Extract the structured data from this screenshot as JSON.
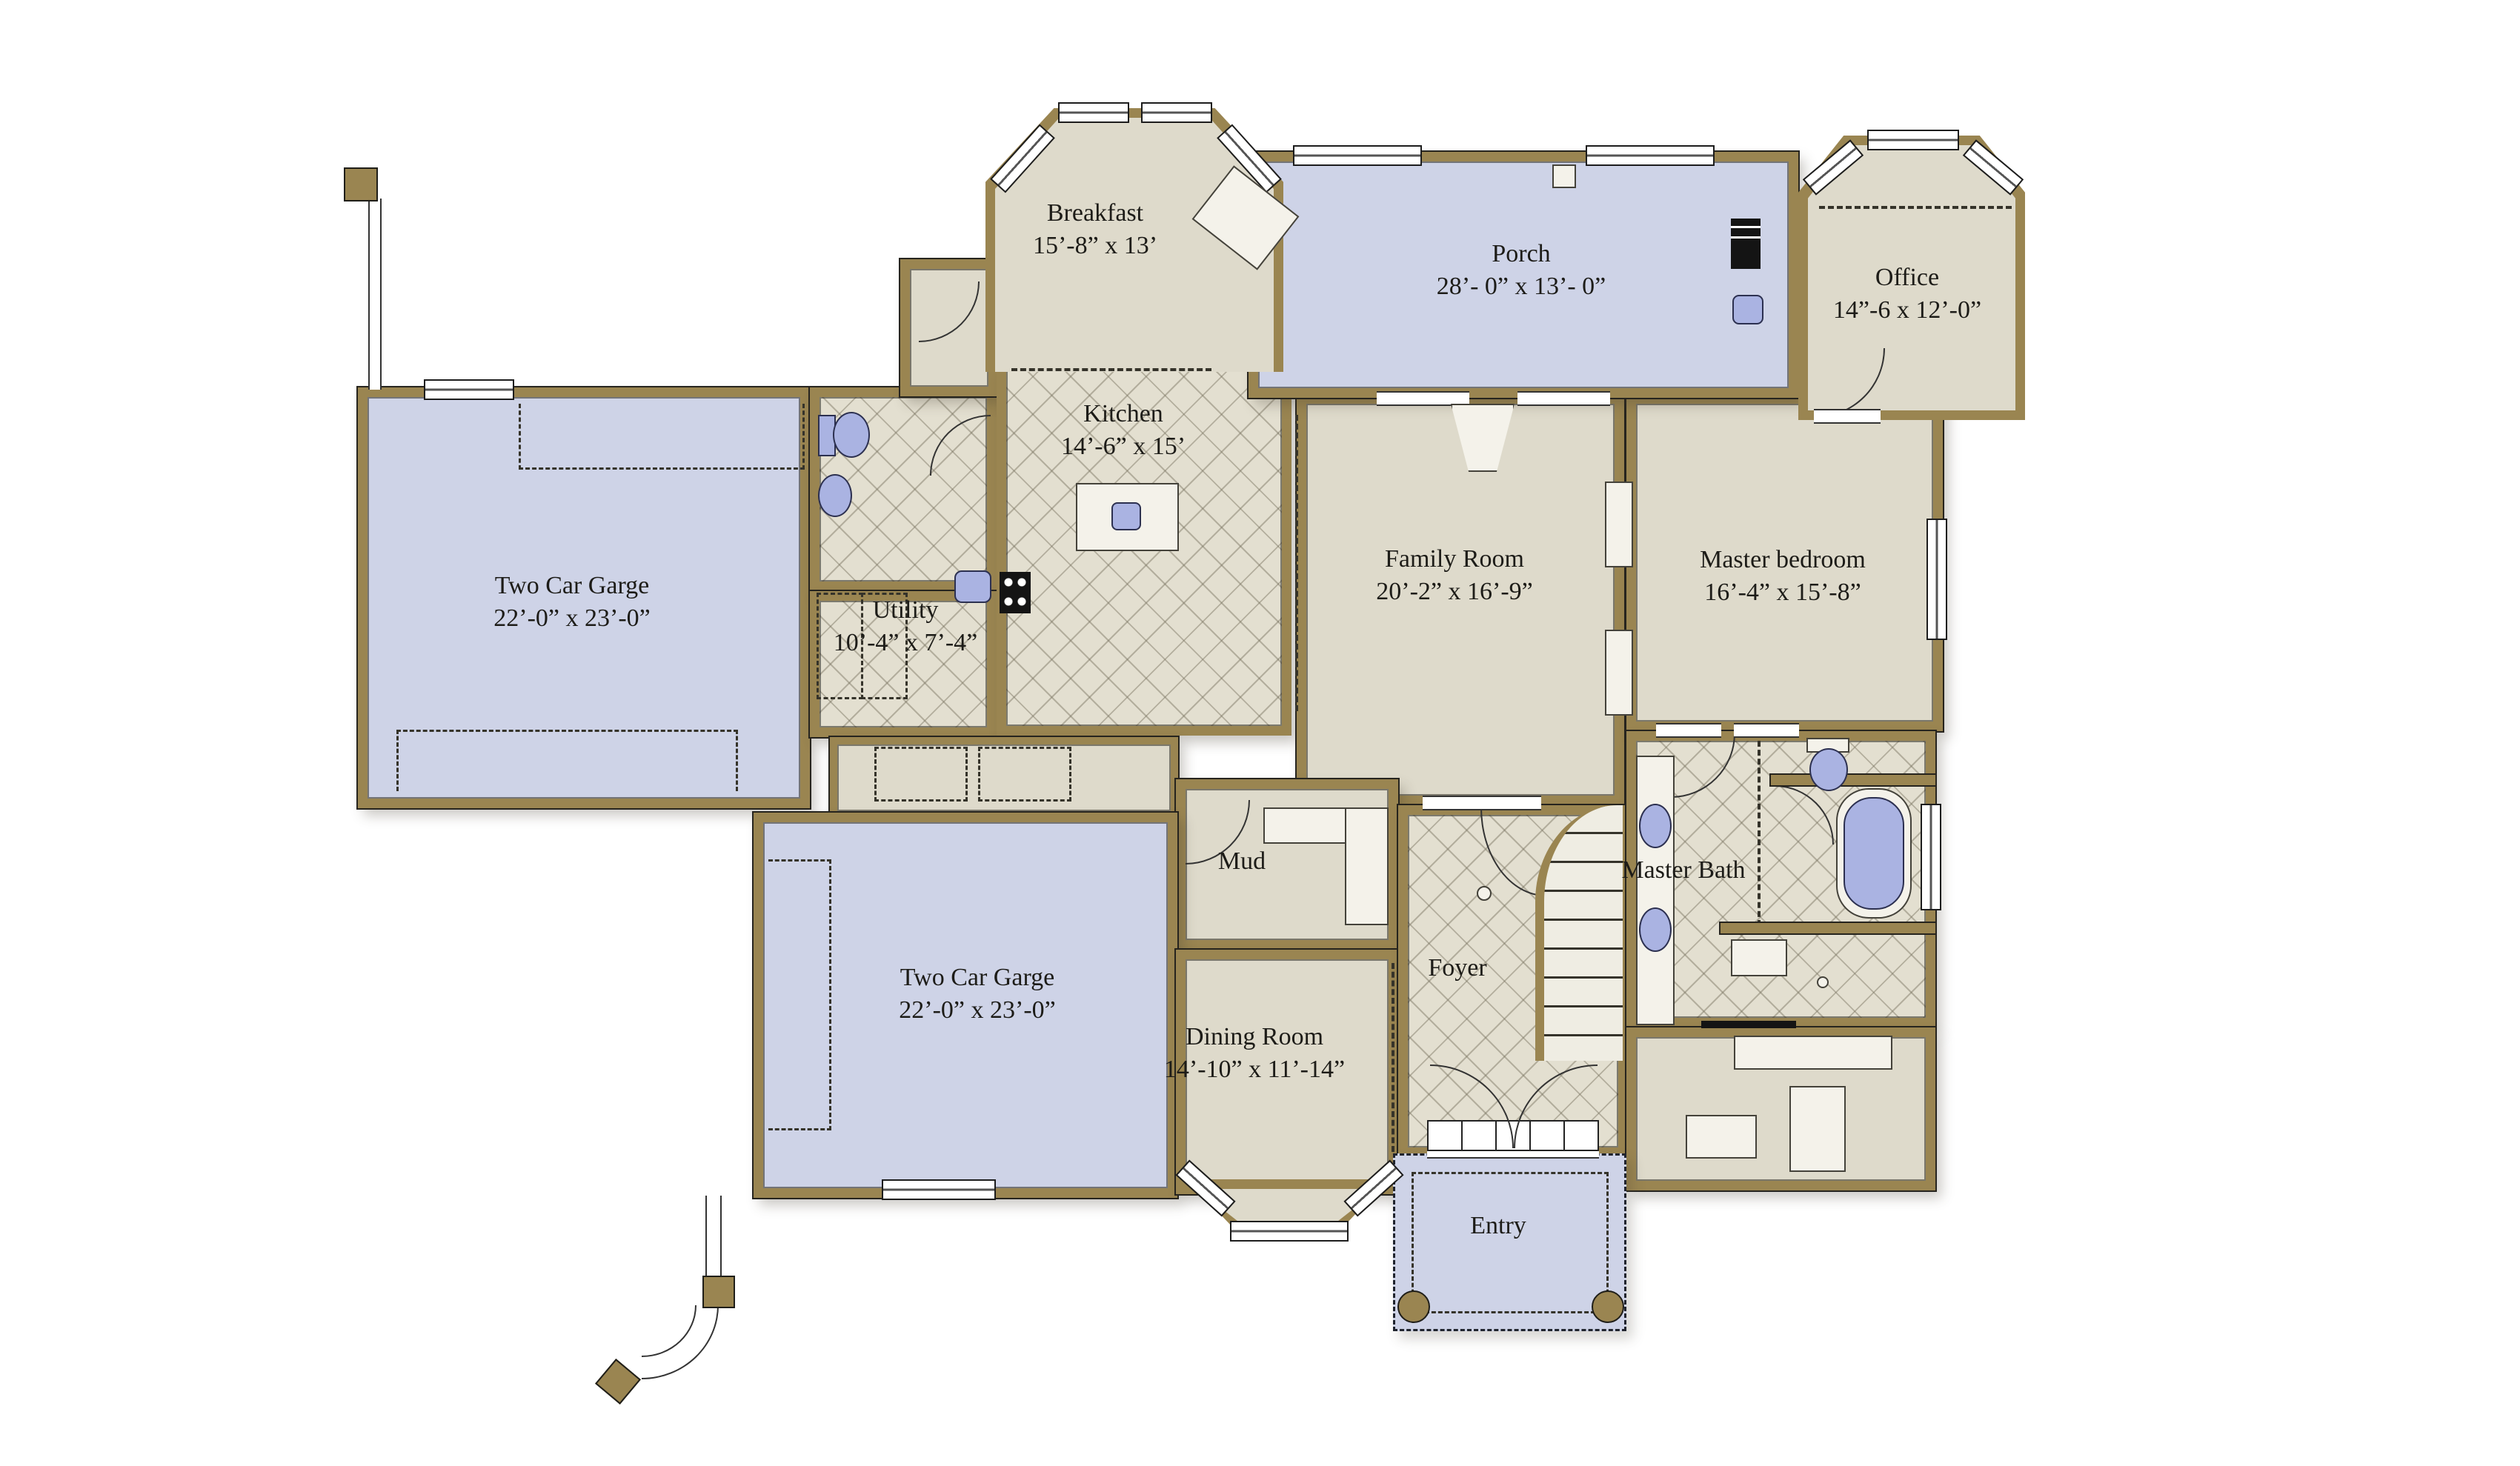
{
  "palette": {
    "wall": "#9a8551",
    "beige": "#dedacb",
    "tile": "#e3dfd0",
    "blue": "#ced3e7",
    "fixture": "#aab3e2",
    "ink": "#1d1c18",
    "line": "#26241e"
  },
  "rooms": {
    "breakfast": {
      "name": "Breakfast",
      "dims": "15’-8” x 13’"
    },
    "porch": {
      "name": "Porch",
      "dims": "28’- 0” x 13’- 0”"
    },
    "office": {
      "name": "Office",
      "dims": "14”-6 x 12’-0”"
    },
    "kitchen": {
      "name": "Kitchen",
      "dims": "14’-6” x 15’"
    },
    "family_room": {
      "name": "Family Room",
      "dims": "20’-2” x 16’-9”"
    },
    "master_bedroom": {
      "name": "Master bedroom",
      "dims": "16’-4” x 15’-8”"
    },
    "garage_upper": {
      "name": "Two Car Garge",
      "dims": "22’-0” x 23’-0”"
    },
    "utility": {
      "name": "Utility",
      "dims": "10’-4” x 7’-4”"
    },
    "mud": {
      "name": "Mud",
      "dims": ""
    },
    "garage_lower": {
      "name": "Two Car Garge",
      "dims": "22’-0” x 23’-0”"
    },
    "dining_room": {
      "name": "Dining Room",
      "dims": "14’-10” x 11’-14”"
    },
    "foyer": {
      "name": "Foyer",
      "dims": ""
    },
    "master_bath": {
      "name": "Master Bath",
      "dims": ""
    },
    "entry": {
      "name": "Entry",
      "dims": ""
    }
  }
}
